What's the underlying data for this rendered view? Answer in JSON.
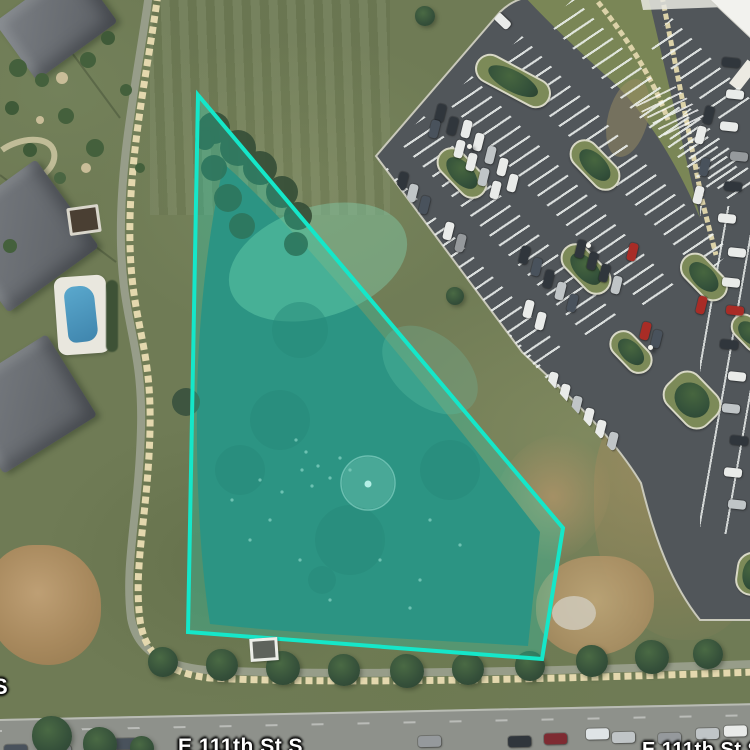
{
  "map": {
    "type": "satellite-aerial",
    "street_labels": [
      {
        "text": "E 111th St S",
        "x": 178,
        "y": 735,
        "size": 21,
        "truncated": "bottom"
      },
      {
        "text": "E 111th St S",
        "x": 642,
        "y": 739,
        "size": 20,
        "truncated": "bottom-right"
      },
      {
        "text": "S",
        "x": -7,
        "y": 674,
        "size": 22,
        "truncated": "left"
      }
    ]
  },
  "overlay": {
    "points": "198,95 563,528 542,659 188,632",
    "stroke_color": "#15E7C9",
    "stroke_width": 4,
    "fill_color": "#15E2C4",
    "fill_opacity": 0.27
  },
  "scene": {
    "car_colors": {
      "w": "#e9ebe9",
      "s": "#c0c5c7",
      "g": "#95999c",
      "d": "#30363c",
      "n": "#49525c",
      "r": "#a82c26",
      "m": "#7e2b32",
      "t": "#dfe4e6"
    },
    "houses": [
      {
        "x": 6,
        "y": -14,
        "w": 100,
        "h": 72,
        "rot": -36
      },
      {
        "x": -34,
        "y": 182,
        "w": 112,
        "h": 108,
        "rot": -36
      },
      {
        "x": -30,
        "y": 356,
        "w": 110,
        "h": 96,
        "rot": -32
      }
    ],
    "bushes": [
      [
        18,
        68,
        9,
        "#44603c"
      ],
      [
        42,
        80,
        7,
        "#44603c"
      ],
      [
        88,
        60,
        8,
        "#44603c"
      ],
      [
        12,
        108,
        7,
        "#3f5a38"
      ],
      [
        66,
        116,
        8,
        "#44603c"
      ],
      [
        30,
        150,
        7,
        "#3f5a38"
      ],
      [
        95,
        148,
        9,
        "#44603c"
      ],
      [
        126,
        90,
        6,
        "#44603c"
      ],
      [
        108,
        38,
        7,
        "#3f5a38"
      ],
      [
        140,
        168,
        5,
        "#44603c"
      ],
      [
        60,
        178,
        6,
        "#4a6542"
      ],
      [
        10,
        246,
        7,
        "#44603c"
      ],
      [
        62,
        78,
        6,
        "#c9bd98"
      ],
      [
        86,
        168,
        5,
        "#c9bd98"
      ],
      [
        40,
        120,
        4,
        "#c9bd98"
      ]
    ],
    "parking": {
      "bands": [
        [
          378,
          158,
          265
        ],
        [
          424,
          116,
          280
        ],
        [
          472,
          76,
          295
        ],
        [
          522,
          36,
          300
        ],
        [
          574,
          -2,
          240
        ],
        [
          406,
          226,
          230
        ],
        [
          452,
          294,
          200
        ],
        [
          505,
          362,
          185
        ],
        [
          558,
          428,
          150
        ],
        [
          672,
          18,
          115
        ],
        [
          690,
          108,
          100
        ]
      ],
      "islands": [
        [
          472,
          66,
          78,
          26,
          28
        ],
        [
          432,
          158,
          56,
          26,
          46
        ],
        [
          565,
          150,
          56,
          26,
          46
        ],
        [
          676,
          262,
          52,
          26,
          46
        ],
        [
          606,
          338,
          46,
          24,
          46
        ],
        [
          663,
          378,
          54,
          40,
          46
        ],
        [
          556,
          254,
          56,
          26,
          46
        ],
        [
          728,
          320,
          40,
          22,
          46
        ],
        [
          736,
          552,
          30,
          40,
          8
        ]
      ],
      "cars": [
        [
          462,
          120,
          "w"
        ],
        [
          474,
          133,
          "w"
        ],
        [
          486,
          146,
          "s"
        ],
        [
          455,
          140,
          "w"
        ],
        [
          467,
          153,
          "w"
        ],
        [
          498,
          158,
          "w"
        ],
        [
          479,
          168,
          "s"
        ],
        [
          491,
          181,
          "w"
        ],
        [
          508,
          174,
          "w"
        ],
        [
          436,
          104,
          "d"
        ],
        [
          448,
          117,
          "d"
        ],
        [
          430,
          120,
          "n"
        ],
        [
          398,
          172,
          "d"
        ],
        [
          408,
          184,
          "s"
        ],
        [
          420,
          196,
          "n"
        ],
        [
          444,
          222,
          "w"
        ],
        [
          456,
          234,
          "g"
        ],
        [
          520,
          246,
          "d"
        ],
        [
          532,
          258,
          "n"
        ],
        [
          544,
          270,
          "d"
        ],
        [
          556,
          282,
          "s"
        ],
        [
          568,
          294,
          "n"
        ],
        [
          524,
          300,
          "w"
        ],
        [
          536,
          312,
          "w"
        ],
        [
          628,
          243,
          "r"
        ],
        [
          697,
          296,
          "r"
        ],
        [
          641,
          322,
          "r"
        ],
        [
          652,
          330,
          "n"
        ],
        [
          548,
          372,
          "w"
        ],
        [
          560,
          384,
          "w"
        ],
        [
          572,
          396,
          "s"
        ],
        [
          584,
          408,
          "w"
        ],
        [
          538,
          392,
          "g"
        ],
        [
          596,
          420,
          "w"
        ],
        [
          608,
          432,
          "s"
        ],
        [
          588,
          252,
          "d"
        ],
        [
          600,
          264,
          "d"
        ],
        [
          612,
          276,
          "s"
        ],
        [
          576,
          240,
          "d"
        ],
        [
          704,
          106,
          "d"
        ],
        [
          696,
          126,
          "w"
        ],
        [
          700,
          158,
          "n"
        ],
        [
          694,
          186,
          "w"
        ]
      ],
      "entrance_car": [
        498,
        12,
        "w",
        -46
      ],
      "strip_cars": [
        [
          722,
          58,
          "d"
        ],
        [
          726,
          90,
          "w"
        ],
        [
          720,
          122,
          "w"
        ],
        [
          730,
          152,
          "g"
        ],
        [
          724,
          182,
          "d"
        ],
        [
          718,
          214,
          "w"
        ],
        [
          728,
          248,
          "w"
        ],
        [
          722,
          278,
          "w"
        ],
        [
          726,
          306,
          "r"
        ],
        [
          720,
          340,
          "d"
        ],
        [
          728,
          372,
          "w"
        ],
        [
          722,
          404,
          "s"
        ],
        [
          730,
          436,
          "d"
        ],
        [
          724,
          468,
          "w"
        ],
        [
          728,
          500,
          "s"
        ]
      ],
      "poles": [
        [
          394,
          58
        ],
        [
          467,
          144
        ],
        [
          586,
          243
        ],
        [
          648,
          345
        ]
      ]
    },
    "trees_row": [
      [
        163,
        662,
        15
      ],
      [
        222,
        665,
        16
      ],
      [
        283,
        668,
        17
      ],
      [
        344,
        670,
        16
      ],
      [
        407,
        671,
        17
      ],
      [
        468,
        669,
        16
      ],
      [
        530,
        666,
        15
      ],
      [
        592,
        661,
        16
      ],
      [
        652,
        657,
        17
      ],
      [
        708,
        654,
        15
      ]
    ],
    "trees_misc": [
      [
        455,
        296,
        9
      ],
      [
        425,
        16,
        10
      ]
    ],
    "trees_road": [
      [
        52,
        736,
        20
      ],
      [
        100,
        744,
        17
      ],
      [
        142,
        748,
        12
      ]
    ],
    "road": {
      "cars": [
        [
          14,
          24,
          "n"
        ],
        [
          58,
          26,
          "g"
        ],
        [
          100,
          22,
          "d"
        ],
        [
          124,
          20,
          "n"
        ],
        [
          428,
          24,
          "g"
        ],
        [
          518,
          26,
          "d"
        ],
        [
          554,
          24,
          "m"
        ],
        [
          596,
          20,
          "t"
        ],
        [
          622,
          24,
          "s"
        ],
        [
          668,
          26,
          "g"
        ],
        [
          706,
          22,
          "s"
        ],
        [
          734,
          20,
          "w"
        ]
      ]
    }
  }
}
